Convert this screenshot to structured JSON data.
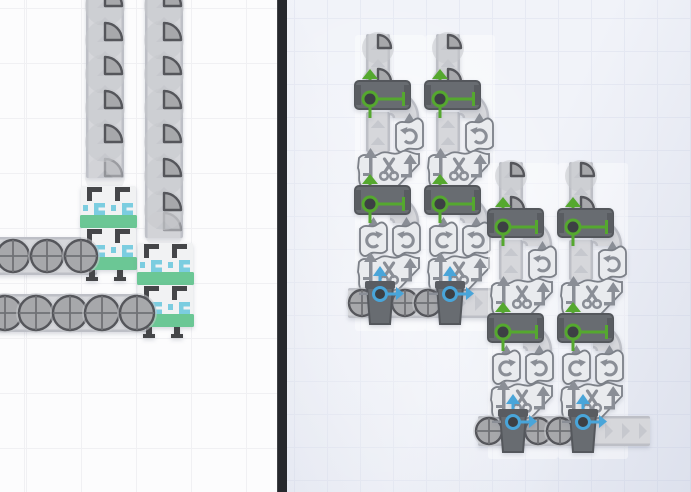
{
  "window": {
    "width": 691,
    "height": 492,
    "description": "split view of a shape-factory building game: live factory on left, grayscale blueprint preview on right"
  },
  "colors": {
    "left_bg": "#fcfcfd",
    "left_grid": "#f0f0f3",
    "right_bg": "#f1f3f9",
    "right_grid": "#e6e9f3",
    "divider": "#26282d",
    "belt_body": "#d6d7db",
    "belt_edge": "#bdbfc6",
    "belt_chevron": "#c6c8ce",
    "item_bg": "#c7c8cc",
    "item_fill": "#a7a8ab",
    "item_stroke": "#55565b",
    "item_cross": "#707175",
    "plate": "#f1f2f3",
    "clamp": "#454649",
    "teal": "#7bcde0",
    "green_bar": "#6bc795",
    "mach_dark": "#686c71",
    "mach_dark2": "#595c61",
    "mach_dark_border": "#54575c",
    "wavy": "#e9ebee",
    "wavy_stroke": "#7c8088",
    "icon": "#8a8e96",
    "green": "#55a82f",
    "blue": "#49a5d9"
  },
  "panels": {
    "left": {
      "tile": 55,
      "grid_offset_x": 26,
      "grid_offset_y": 8
    },
    "right": {
      "tile": 33,
      "grid_offset_x": 7,
      "grid_offset_y": 18
    }
  },
  "left_objects": [
    {
      "t": "belt",
      "dir": "v",
      "x": 86,
      "y": -8,
      "w": 38,
      "h": 186
    },
    {
      "t": "belt",
      "dir": "v",
      "x": 145,
      "y": -8,
      "w": 38,
      "h": 246
    },
    {
      "t": "belt",
      "dir": "h",
      "x": -4,
      "y": 237,
      "w": 101,
      "h": 38
    },
    {
      "t": "belt",
      "dir": "h",
      "x": -4,
      "y": 294,
      "w": 154,
      "h": 38
    },
    {
      "t": "item",
      "shape": "quarter",
      "r": 17,
      "cx": 105,
      "cy": 176,
      "o": 0.45
    },
    {
      "t": "item",
      "shape": "quarter",
      "r": 17,
      "cx": 164,
      "cy": 230,
      "o": 0.45
    },
    {
      "t": "stacker",
      "x": 80,
      "y": 186
    },
    {
      "t": "stacker",
      "x": 80,
      "y": 228,
      "feet": true
    },
    {
      "t": "stacker",
      "x": 137,
      "y": 243
    },
    {
      "t": "stacker",
      "x": 137,
      "y": 285,
      "feet": true
    },
    {
      "t": "item",
      "shape": "quarter",
      "r": 17,
      "cx": 105,
      "cy": 6
    },
    {
      "t": "item",
      "shape": "quarter",
      "r": 17,
      "cx": 105,
      "cy": 40
    },
    {
      "t": "item",
      "shape": "quarter",
      "r": 17,
      "cx": 105,
      "cy": 74
    },
    {
      "t": "item",
      "shape": "quarter",
      "r": 17,
      "cx": 105,
      "cy": 108
    },
    {
      "t": "item",
      "shape": "quarter",
      "r": 17,
      "cx": 105,
      "cy": 142
    },
    {
      "t": "item",
      "shape": "quarter",
      "r": 17,
      "cx": 164,
      "cy": 6
    },
    {
      "t": "item",
      "shape": "quarter",
      "r": 17,
      "cx": 164,
      "cy": 40
    },
    {
      "t": "item",
      "shape": "quarter",
      "r": 17,
      "cx": 164,
      "cy": 74
    },
    {
      "t": "item",
      "shape": "quarter",
      "r": 17,
      "cx": 164,
      "cy": 108
    },
    {
      "t": "item",
      "shape": "quarter",
      "r": 17,
      "cx": 164,
      "cy": 142
    },
    {
      "t": "item",
      "shape": "quarter",
      "r": 17,
      "cx": 164,
      "cy": 176
    },
    {
      "t": "item",
      "shape": "quarter",
      "r": 17,
      "cx": 164,
      "cy": 210
    },
    {
      "t": "item",
      "shape": "circle",
      "r": 16,
      "cx": 13,
      "cy": 256
    },
    {
      "t": "item",
      "shape": "circle",
      "r": 16,
      "cx": 47,
      "cy": 256
    },
    {
      "t": "item",
      "shape": "circle",
      "r": 16,
      "cx": 81,
      "cy": 256
    },
    {
      "t": "item",
      "shape": "circle",
      "r": 17,
      "cx": 5,
      "cy": 313
    },
    {
      "t": "item",
      "shape": "circle",
      "r": 17,
      "cx": 36,
      "cy": 313
    },
    {
      "t": "item",
      "shape": "circle",
      "r": 17,
      "cx": 70,
      "cy": 313
    },
    {
      "t": "item",
      "shape": "circle",
      "r": 17,
      "cx": 102,
      "cy": 313
    },
    {
      "t": "item",
      "shape": "circle",
      "r": 17,
      "cx": 137,
      "cy": 313
    }
  ],
  "right_clusters": [
    {
      "x": 356,
      "y": 40,
      "col_offsets": [
        0,
        70
      ],
      "belt": {
        "x": 348,
        "y": 288,
        "w": 152,
        "h": 30
      },
      "belt_items_x": [
        362,
        405,
        428
      ]
    },
    {
      "x": 489,
      "y": 168,
      "col_offsets": [
        0,
        70
      ],
      "belt": {
        "x": 478,
        "y": 416,
        "w": 172,
        "h": 30
      },
      "belt_items_x": [
        489,
        538,
        560
      ]
    }
  ],
  "right_item_radius": 13
}
